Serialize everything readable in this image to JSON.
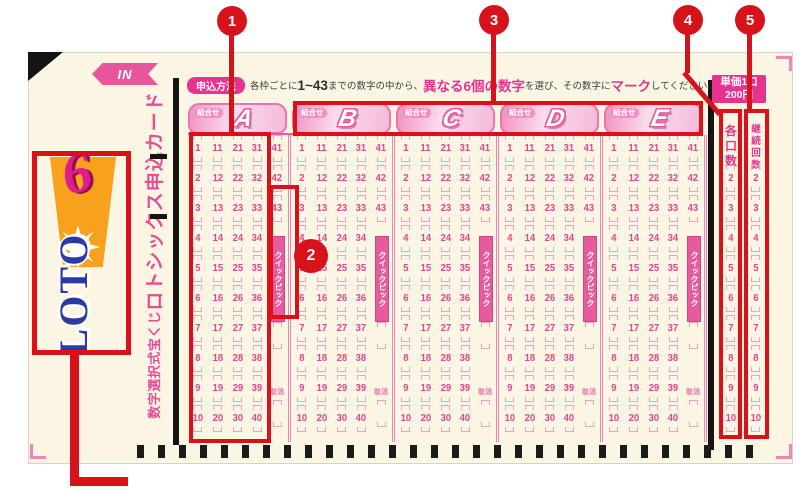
{
  "colors": {
    "card_bg": "#fbf6e4",
    "pink": "#e74d97",
    "pink_light": "#f2a0c6",
    "magenta": "#e7338d",
    "annotation_red": "#dc1018",
    "badge_red": "#d6121b",
    "black": "#141414",
    "logo_orange": "#f7a11c",
    "logo_blue": "#2b3aa5",
    "logo_pink": "#e31a8d"
  },
  "callouts": {
    "labels": [
      "1",
      "2",
      "3",
      "4",
      "5"
    ]
  },
  "card": {
    "in_label": "IN",
    "side_title_small": "数字選択式宝くじ",
    "side_title_large": "ロトシックス申込カード",
    "logo": {
      "brand": "LOTO",
      "six": "6"
    },
    "instruction": {
      "label": "申込方法",
      "parts": [
        {
          "t": "各枠ごとに",
          "s": "r"
        },
        {
          "t": "1~43",
          "s": "b"
        },
        {
          "t": "までの数字の中から、",
          "s": "r"
        },
        {
          "t": "異なる6個の数字",
          "s": "p"
        },
        {
          "t": "を選び、その数字に",
          "s": "r"
        },
        {
          "t": "マーク",
          "s": "p"
        },
        {
          "t": "してください。",
          "s": "r"
        }
      ]
    },
    "unit_price_line1": "単価1口",
    "unit_price_line2": "200円",
    "combo_label": "組合せ",
    "block_letters": [
      "A",
      "B",
      "C",
      "D",
      "E"
    ],
    "number_columns": [
      [
        1,
        2,
        3,
        4,
        5,
        6,
        7,
        8,
        9,
        10
      ],
      [
        11,
        12,
        13,
        14,
        15,
        16,
        17,
        18,
        19,
        20
      ],
      [
        21,
        22,
        23,
        24,
        25,
        26,
        27,
        28,
        29,
        30
      ],
      [
        31,
        32,
        33,
        34,
        35,
        36,
        37,
        38,
        39,
        40
      ],
      [
        41,
        42,
        43
      ]
    ],
    "quick_pick_label": "クイックピック",
    "cancel_label": "取消",
    "option_columns": [
      {
        "title": "各口数",
        "values": [
          2,
          3,
          4,
          5,
          6,
          7,
          8,
          9,
          10
        ]
      },
      {
        "title": "継続回数",
        "values": [
          2,
          3,
          4,
          5,
          6,
          7,
          8,
          9,
          10
        ]
      }
    ],
    "timing_marks_count": 30
  }
}
